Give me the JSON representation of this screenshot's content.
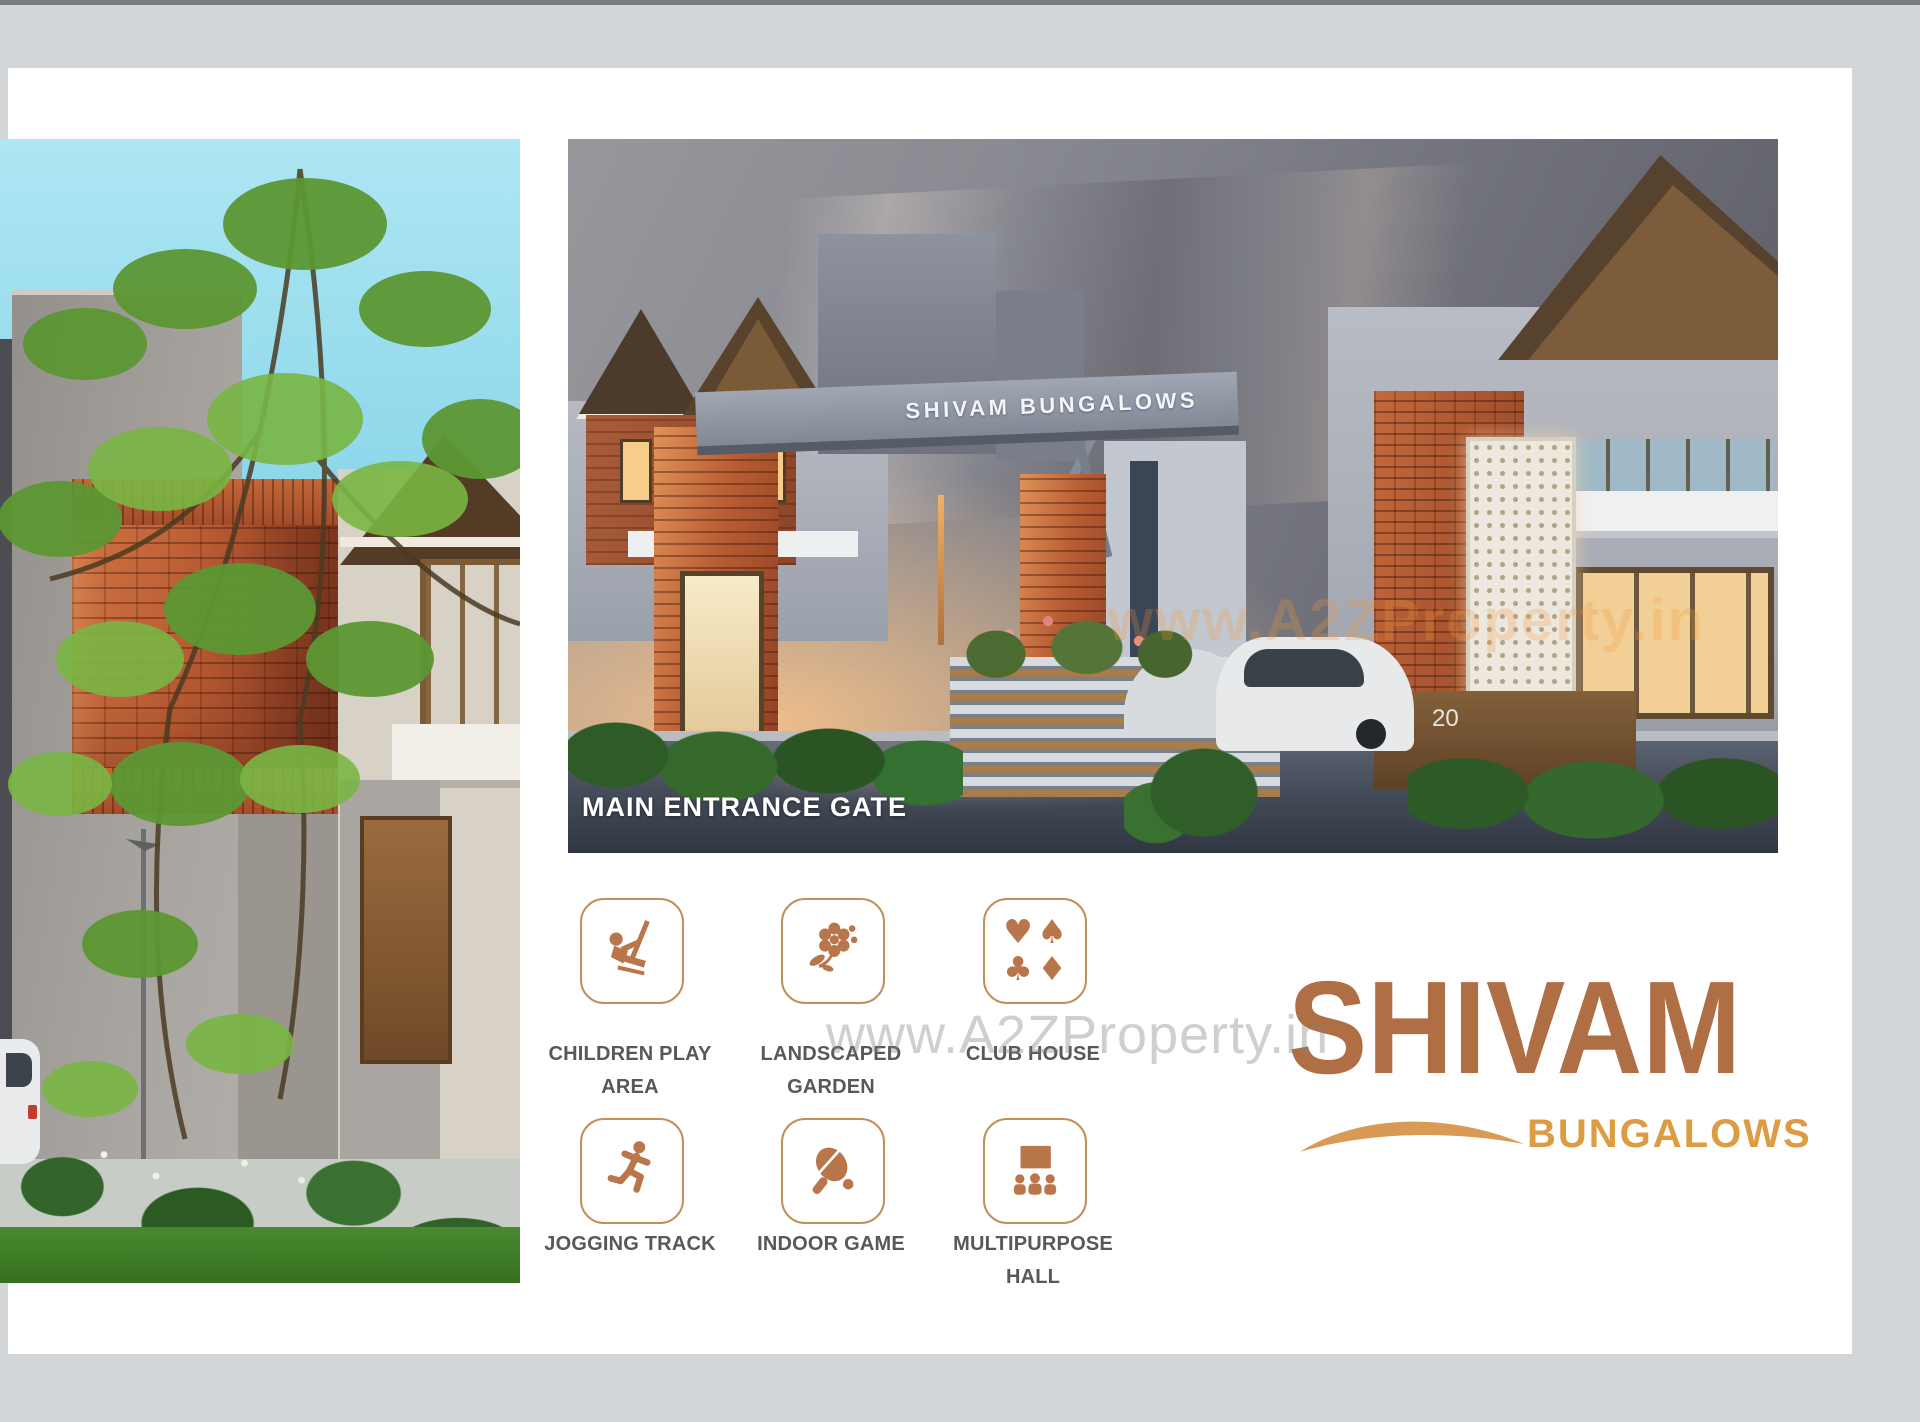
{
  "page": {
    "background": "#d3d6d8",
    "sheet_color": "#ffffff",
    "top_strip_color": "#7b7d80"
  },
  "main_photo": {
    "gate_sign": "SHIVAM BUNGALOWS",
    "caption": "MAIN ENTRANCE GATE",
    "house_number": "20",
    "photo_watermark": "www.A2ZProperty.in"
  },
  "watermark": {
    "text": "www.A2ZProperty.in"
  },
  "amenities": [
    {
      "icon": "swing-child-icon",
      "line1": "CHILDREN PLAY",
      "line2": "AREA"
    },
    {
      "icon": "flower-icon",
      "line1": "LANDSCAPED",
      "line2": "GARDEN"
    },
    {
      "icon": "card-suits-icon",
      "line1": "CLUB HOUSE",
      "line2": ""
    },
    {
      "icon": "running-man-icon",
      "line1": "JOGGING TRACK",
      "line2": ""
    },
    {
      "icon": "table-tennis-icon",
      "line1": "INDOOR GAME",
      "line2": ""
    },
    {
      "icon": "audience-screen-icon",
      "line1": "MULTIPURPOSE",
      "line2": "HALL"
    }
  ],
  "suits": {
    "heart": "♥",
    "spade": "♠",
    "club": "♣",
    "diamond": "♦"
  },
  "logo": {
    "title": "SHIVAM",
    "subtitle": "BUNGALOWS"
  },
  "colors": {
    "amenity_icon": "#b9764b",
    "amenity_border": "#bf9159",
    "amenity_label": "#57585c",
    "logo_title": "#b06e45",
    "logo_subtitle": "#dd9b42"
  }
}
